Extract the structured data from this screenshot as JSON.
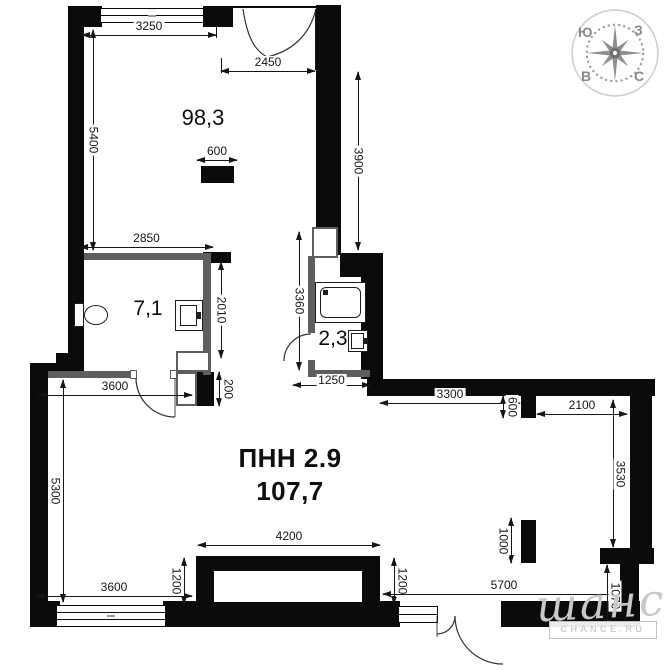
{
  "rooms": {
    "main": {
      "name": "ПНН 2.9",
      "area": "107,7"
    },
    "living": {
      "area": "98,3"
    },
    "wc": {
      "area": "7,1"
    },
    "bath": {
      "area": "2,3"
    }
  },
  "dimensions": [
    {
      "label": "3250",
      "o": "h",
      "x": 82,
      "y": 35,
      "len": 134
    },
    {
      "label": "2450",
      "o": "h",
      "x": 221,
      "y": 71,
      "len": 94
    },
    {
      "label": "5400",
      "o": "v",
      "x": 93,
      "y": 30,
      "len": 220,
      "toff": 0
    },
    {
      "label": "3900",
      "o": "v",
      "x": 358,
      "y": 72,
      "len": 178,
      "toff": 0
    },
    {
      "label": "600",
      "o": "h",
      "x": 197,
      "y": 160,
      "len": 40
    },
    {
      "label": "2850",
      "o": "h",
      "x": 80,
      "y": 247,
      "len": 133
    },
    {
      "label": "2010",
      "o": "v",
      "x": 221,
      "y": 262,
      "len": 96,
      "toff": 0
    },
    {
      "label": "3360",
      "o": "v",
      "x": 299,
      "y": 232,
      "len": 138,
      "toff": 0
    },
    {
      "label": "1250",
      "o": "h",
      "x": 293,
      "y": 385,
      "len": 77,
      "toff": -11
    },
    {
      "label": "200",
      "o": "v",
      "x": 219,
      "y": 372,
      "len": 34,
      "toff": 9
    },
    {
      "label": "3600",
      "o": "h",
      "x": 38,
      "y": 395,
      "len": 154
    },
    {
      "label": "3300",
      "o": "h",
      "x": 380,
      "y": 403,
      "len": 140
    },
    {
      "label": "600",
      "o": "v",
      "x": 503,
      "y": 396,
      "len": 22,
      "toff": 9
    },
    {
      "label": "2100",
      "o": "h",
      "x": 537,
      "y": 414,
      "len": 90
    },
    {
      "label": "3530",
      "o": "v",
      "x": 613,
      "y": 400,
      "len": 147,
      "toff": 7
    },
    {
      "label": "5300",
      "o": "v",
      "x": 63,
      "y": 380,
      "len": 222,
      "toff": -8
    },
    {
      "label": "4200",
      "o": "h",
      "x": 198,
      "y": 545,
      "len": 182
    },
    {
      "label": "1200",
      "o": "v",
      "x": 184,
      "y": 558,
      "len": 46,
      "toff": -8
    },
    {
      "label": "1200",
      "o": "v",
      "x": 394,
      "y": 558,
      "len": 46,
      "toff": 8
    },
    {
      "label": "1000",
      "o": "v",
      "x": 511,
      "y": 518,
      "len": 45,
      "toff": -8
    },
    {
      "label": "5700",
      "o": "h",
      "x": 383,
      "y": 594,
      "len": 242
    },
    {
      "label": "1070",
      "o": "v",
      "x": 607,
      "y": 565,
      "len": 62,
      "toff": 8
    },
    {
      "label": "3600",
      "o": "h",
      "x": 36,
      "y": 596,
      "len": 156
    }
  ],
  "compass": {
    "nw": "Ю",
    "ne": "З",
    "sw": "В",
    "se": "С"
  },
  "watermark": {
    "logo": "шанс",
    "site": "CHANCE.RU"
  },
  "colors": {
    "wall": "#0b0b0b",
    "partition": "#5e5e5e",
    "dim_text": "#161616",
    "compass": "#8e8e8e",
    "watermark": "#c9c9c9"
  }
}
